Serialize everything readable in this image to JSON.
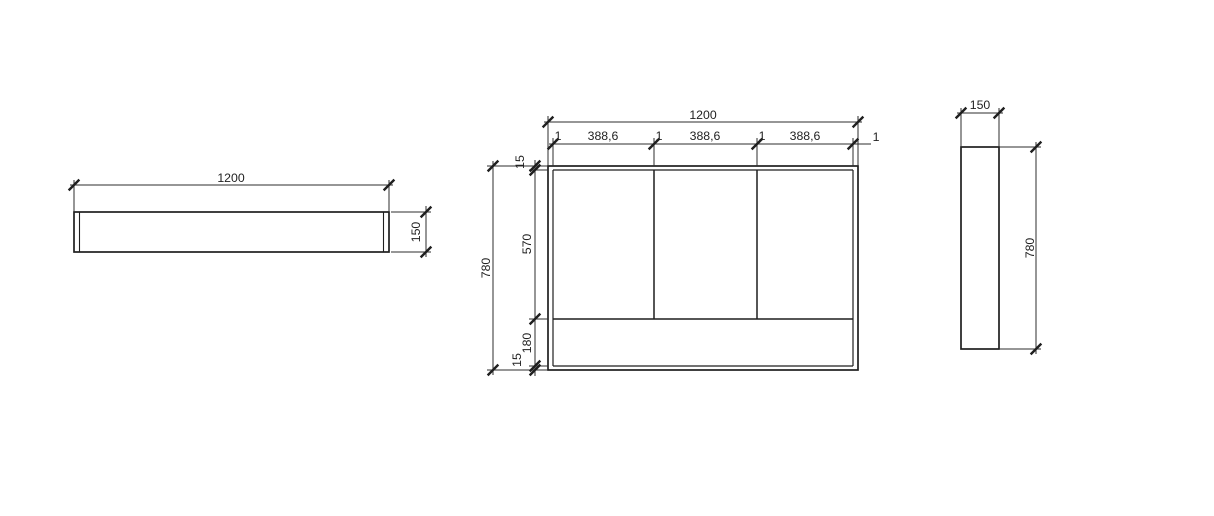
{
  "colors": {
    "background": "#ffffff",
    "object_line": "#1f1f1f",
    "dimension_line": "#2e2e2e",
    "text": "#222222"
  },
  "top_view": {
    "width": "1200",
    "depth": "150"
  },
  "front_view": {
    "width": "1200",
    "height": "780",
    "segments": [
      "1",
      "388,6",
      "1",
      "388,6",
      "1",
      "388,6",
      "1"
    ],
    "top_thickness": "15",
    "opening_height": "570",
    "plinth_height": "180",
    "bottom_thickness": "15"
  },
  "side_view": {
    "depth": "150",
    "height": "780"
  }
}
